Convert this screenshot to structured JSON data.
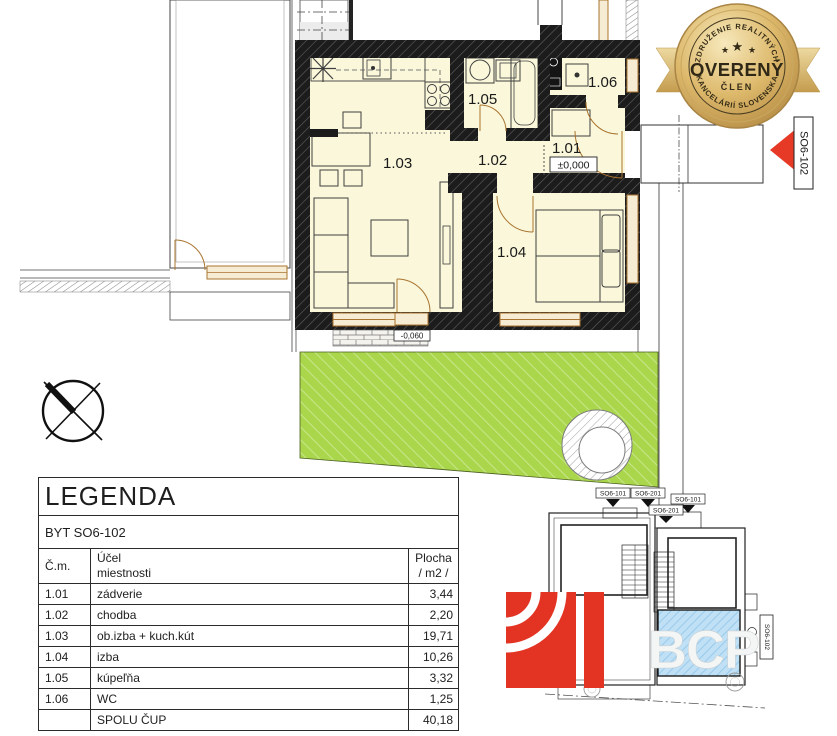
{
  "badge": {
    "arc_top": "ZDRUŽENIE REALITNÝCH",
    "title": "OVERENÝ",
    "subtitle": "ČLEN",
    "arc_bottom": "KANCELÁRIÍ SLOVENSKA",
    "star_center": "★",
    "star_left": "★",
    "star_right": "★"
  },
  "plan": {
    "room_labels": {
      "r101": "1.01",
      "r102": "1.02",
      "r103": "1.03",
      "r104": "1.04",
      "r105": "1.05",
      "r106": "1.06"
    },
    "levels": {
      "interior": "±0,000",
      "entrance": "-0,020",
      "terrace": "-0,060"
    },
    "unit_marker": "SO6-102"
  },
  "legend": {
    "title": "LEGENDA",
    "subtitle": "BYT SO6-102",
    "col_no": "Č.m.",
    "col_purpose": "Účel\nmiestnosti",
    "col_area": "Plocha\n/ m2 /",
    "rows": [
      {
        "no": "1.01",
        "name": "zádverie",
        "area": "3,44"
      },
      {
        "no": "1.02",
        "name": "chodba",
        "area": "2,20"
      },
      {
        "no": "1.03",
        "name": "ob.izba + kuch.kút",
        "area": "19,71"
      },
      {
        "no": "1.04",
        "name": "izba",
        "area": "10,26"
      },
      {
        "no": "1.05",
        "name": "kúpeľňa",
        "area": "3,32"
      },
      {
        "no": "1.06",
        "name": "WC",
        "area": "1,25"
      }
    ],
    "total_label": "SPOLU ČUP",
    "total_value": "40,18"
  },
  "minimap": {
    "labels": [
      {
        "text": "SO6-101"
      },
      {
        "text": "SO6-201"
      },
      {
        "text": "SO6-101"
      },
      {
        "text": "SO6-201"
      }
    ],
    "label_right": "SO6-102"
  },
  "watermark": {
    "text": "BCP"
  },
  "colors": {
    "room_fill": "#FAF7DA",
    "wall": "#1C1C1C",
    "garden_green": "#A9D64B",
    "window_frame": "#A9742F",
    "arrow_red": "#E63A26",
    "badge_gold": "#D8B267",
    "minimap_highlight": "#BFE0F5",
    "logo_red": "#E23323"
  }
}
